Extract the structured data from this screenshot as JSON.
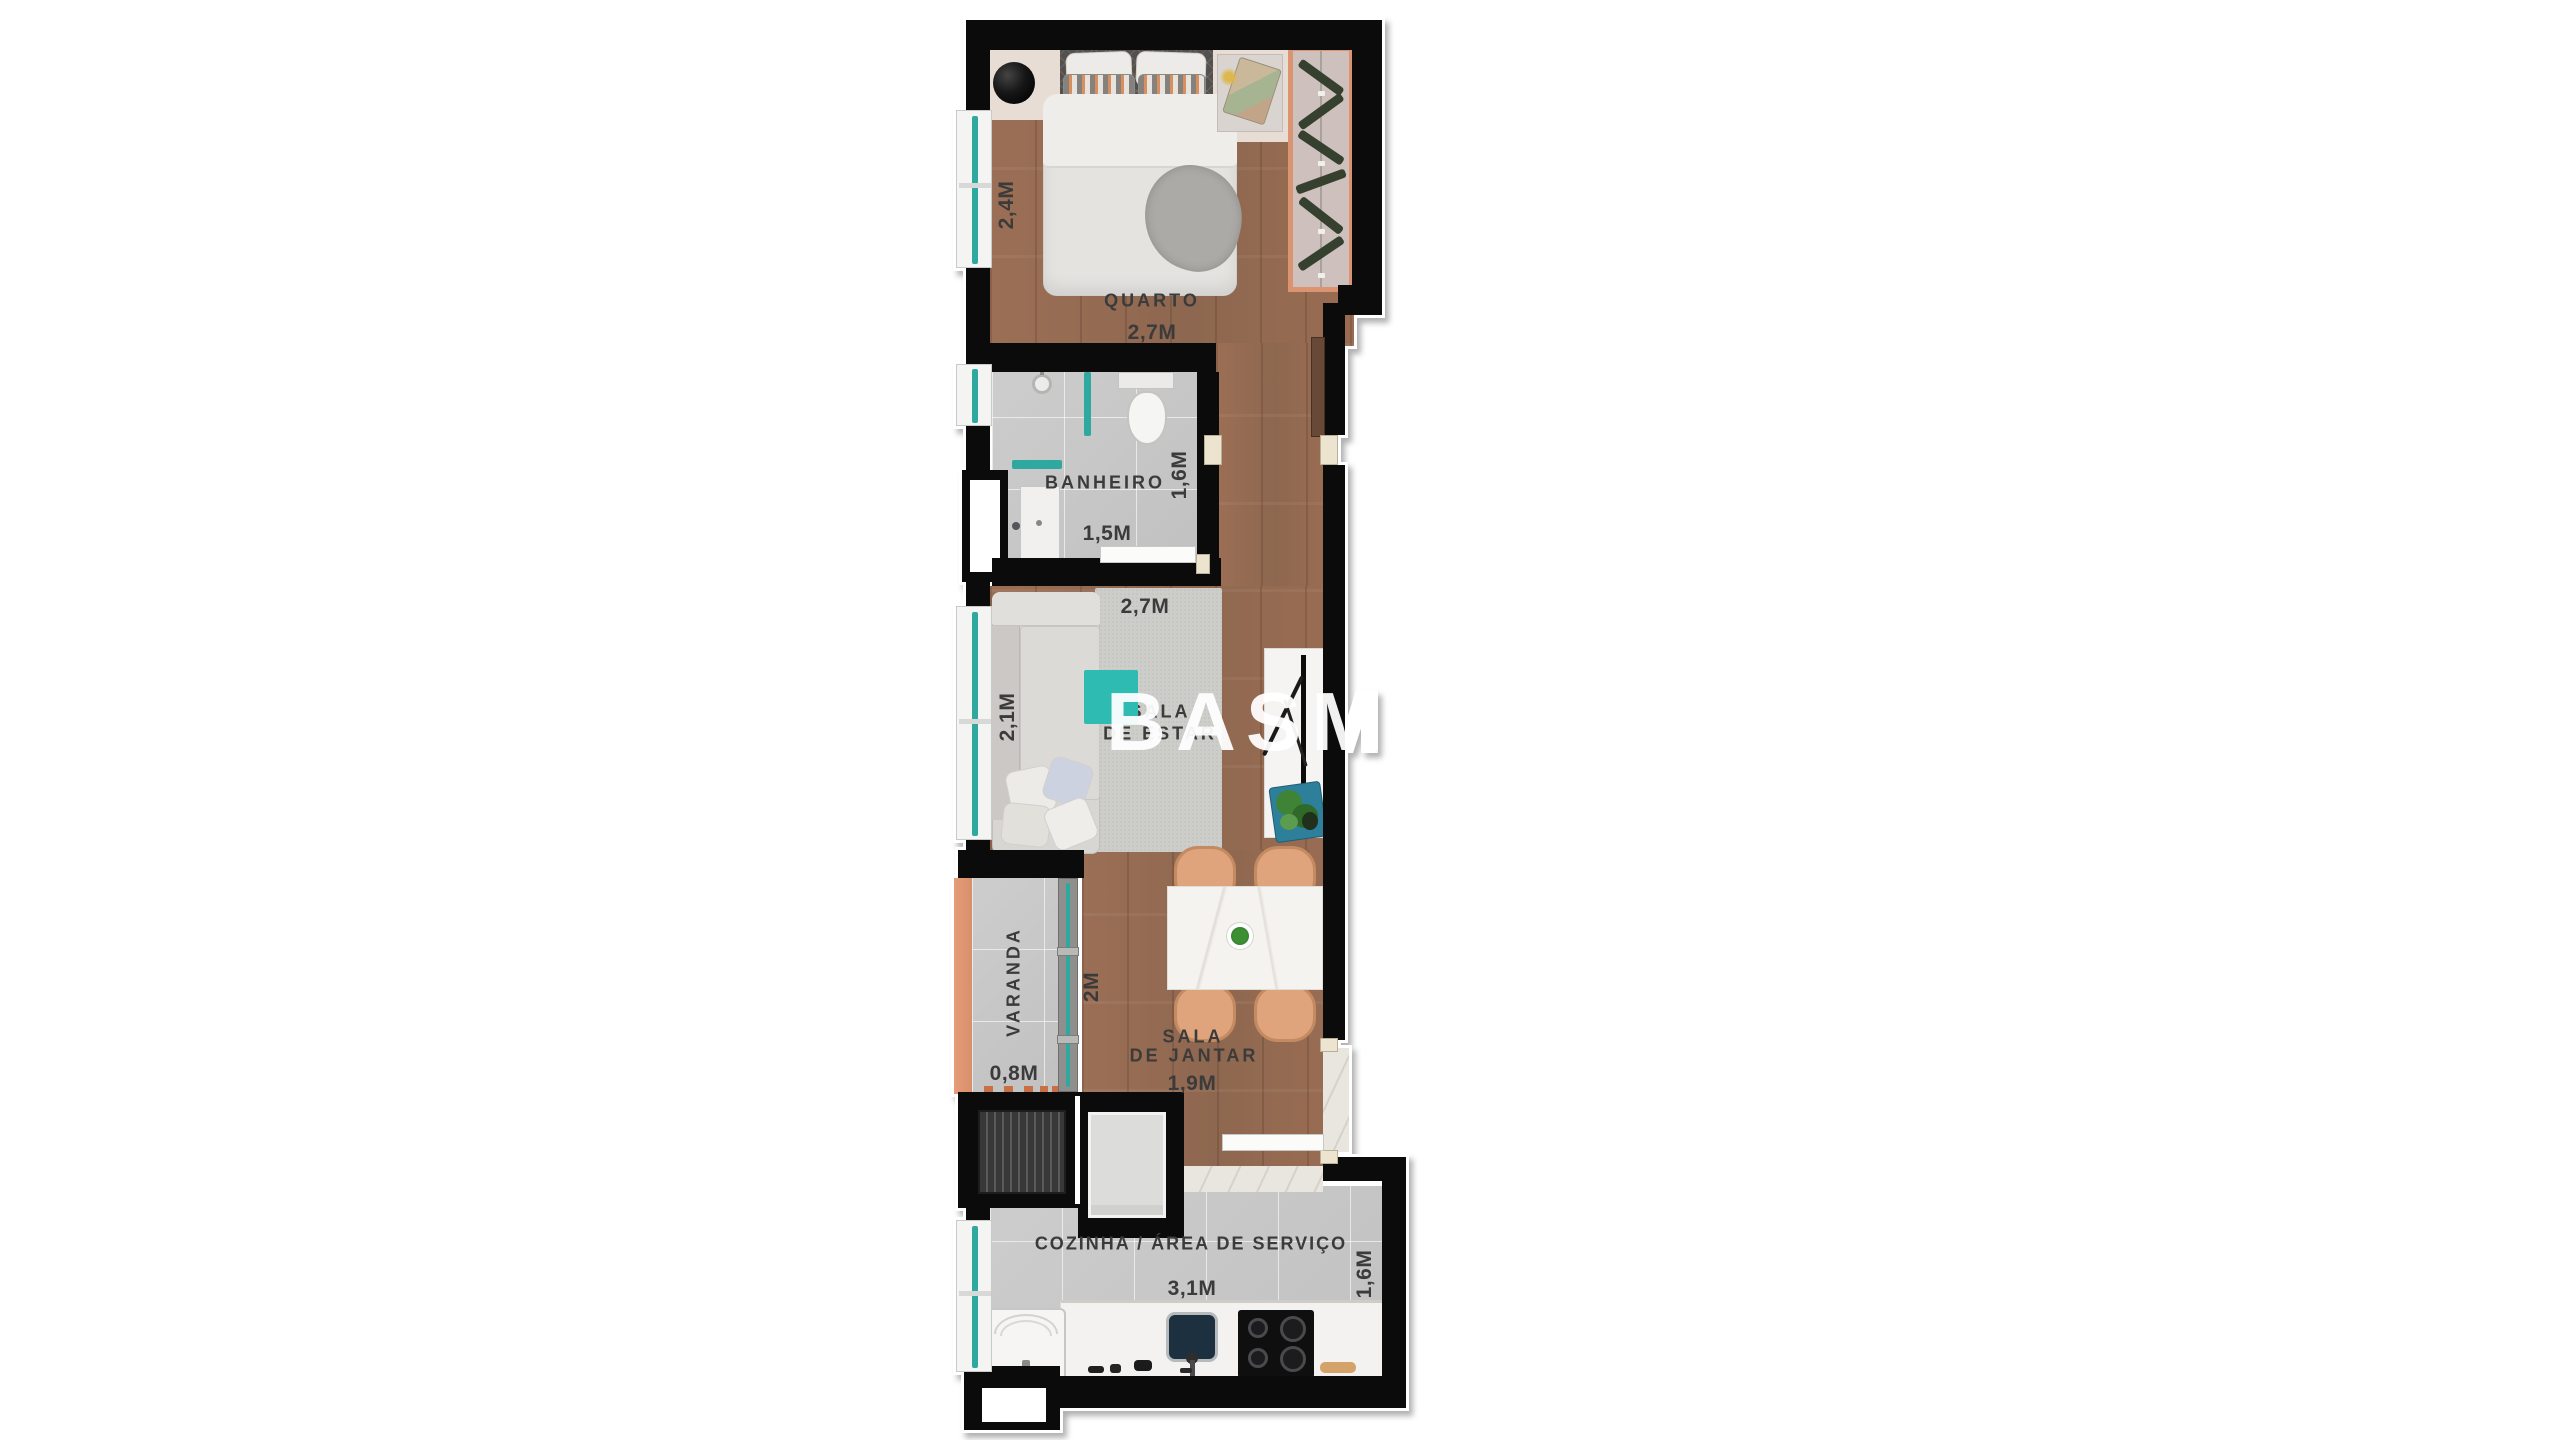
{
  "watermark": {
    "text": "BASM",
    "accent_color": "#2ebcb2"
  },
  "rooms": {
    "quarto": {
      "name": "QUARTO",
      "width": "2,7M",
      "depth": "2,4M"
    },
    "banheiro": {
      "name": "BANHEIRO",
      "width": "1,5M",
      "depth": "1,6M"
    },
    "sala_de_estar": {
      "name_line1": "SALA",
      "name_line2": "DE ESTAR",
      "width": "2,7M",
      "depth": "2,1M"
    },
    "varanda": {
      "name": "VARANDA",
      "width": "0,8M",
      "door_width": "2M"
    },
    "sala_de_jantar": {
      "name_line1": "SALA",
      "name_line2": "DE JANTAR",
      "width": "1,9M"
    },
    "cozinha": {
      "name": "COZINHA / ÁREA DE SERVIÇO",
      "width": "3,1M",
      "depth": "1,6M"
    }
  },
  "colors": {
    "wall": "#0b0b0b",
    "wood_floor": "#9a6e54",
    "tile_floor": "#c8c8c8",
    "glass_teal": "#2fa9a0",
    "wardrobe_salmon": "#dc9370",
    "varanda_salmon": "#e59c78",
    "chair_tan": "#e0a47d",
    "label_text": "#3b3b3b"
  }
}
